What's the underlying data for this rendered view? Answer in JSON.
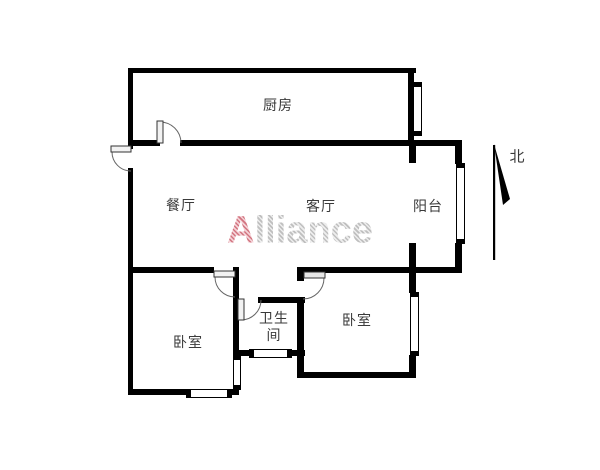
{
  "document": {
    "type": "apartment-floor-plan"
  },
  "rooms": {
    "kitchen": "厨房",
    "dining": "餐厅",
    "living": "客厅",
    "balcony": "阳台",
    "bedroom_left": "卧室",
    "bedroom_right": "卧室",
    "bathroom": "卫生间"
  },
  "compass": {
    "label": "北"
  },
  "watermark": {
    "first_letter": "A",
    "rest": "lliance"
  },
  "colors": {
    "wall": "#000000",
    "watermark_first": "#d2737f",
    "watermark_rest": "#c6c6c6",
    "label_text": "#3a3a3a"
  }
}
